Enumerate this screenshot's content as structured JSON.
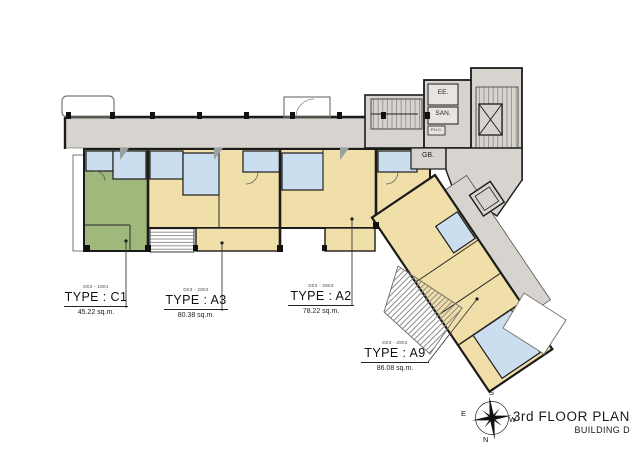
{
  "title": {
    "line1": "3rd FLOOR PLAN",
    "line2": "BUILDING D"
  },
  "compass": {
    "top": "S",
    "bottom": "N",
    "left": "E",
    "right": "W"
  },
  "rooms": {
    "ee": "EE.",
    "san": "SAN.",
    "gb": "GB.",
    "phc": "P.H.C."
  },
  "units": [
    {
      "id": "C1",
      "code": "D03 - 1801",
      "type_label": "TYPE : C1",
      "area": "45.22 sq.m."
    },
    {
      "id": "A3",
      "code": "D03 - 2802",
      "type_label": "TYPE : A3",
      "area": "80.38 sq.m."
    },
    {
      "id": "A2",
      "code": "D03 - 2803",
      "type_label": "TYPE : A2",
      "area": "78.22 sq.m."
    },
    {
      "id": "A9",
      "code": "D03 - 2804",
      "type_label": "TYPE : A9",
      "area": "86.08 sq.m."
    }
  ],
  "colors": {
    "common_gray": "#d7d3ce",
    "unit_beige": "#f1dfa9",
    "unit_green": "#a0b87b",
    "wet_blue": "#cadef0",
    "room_light": "#e8e5e1",
    "wall": "#1b1b1b"
  }
}
